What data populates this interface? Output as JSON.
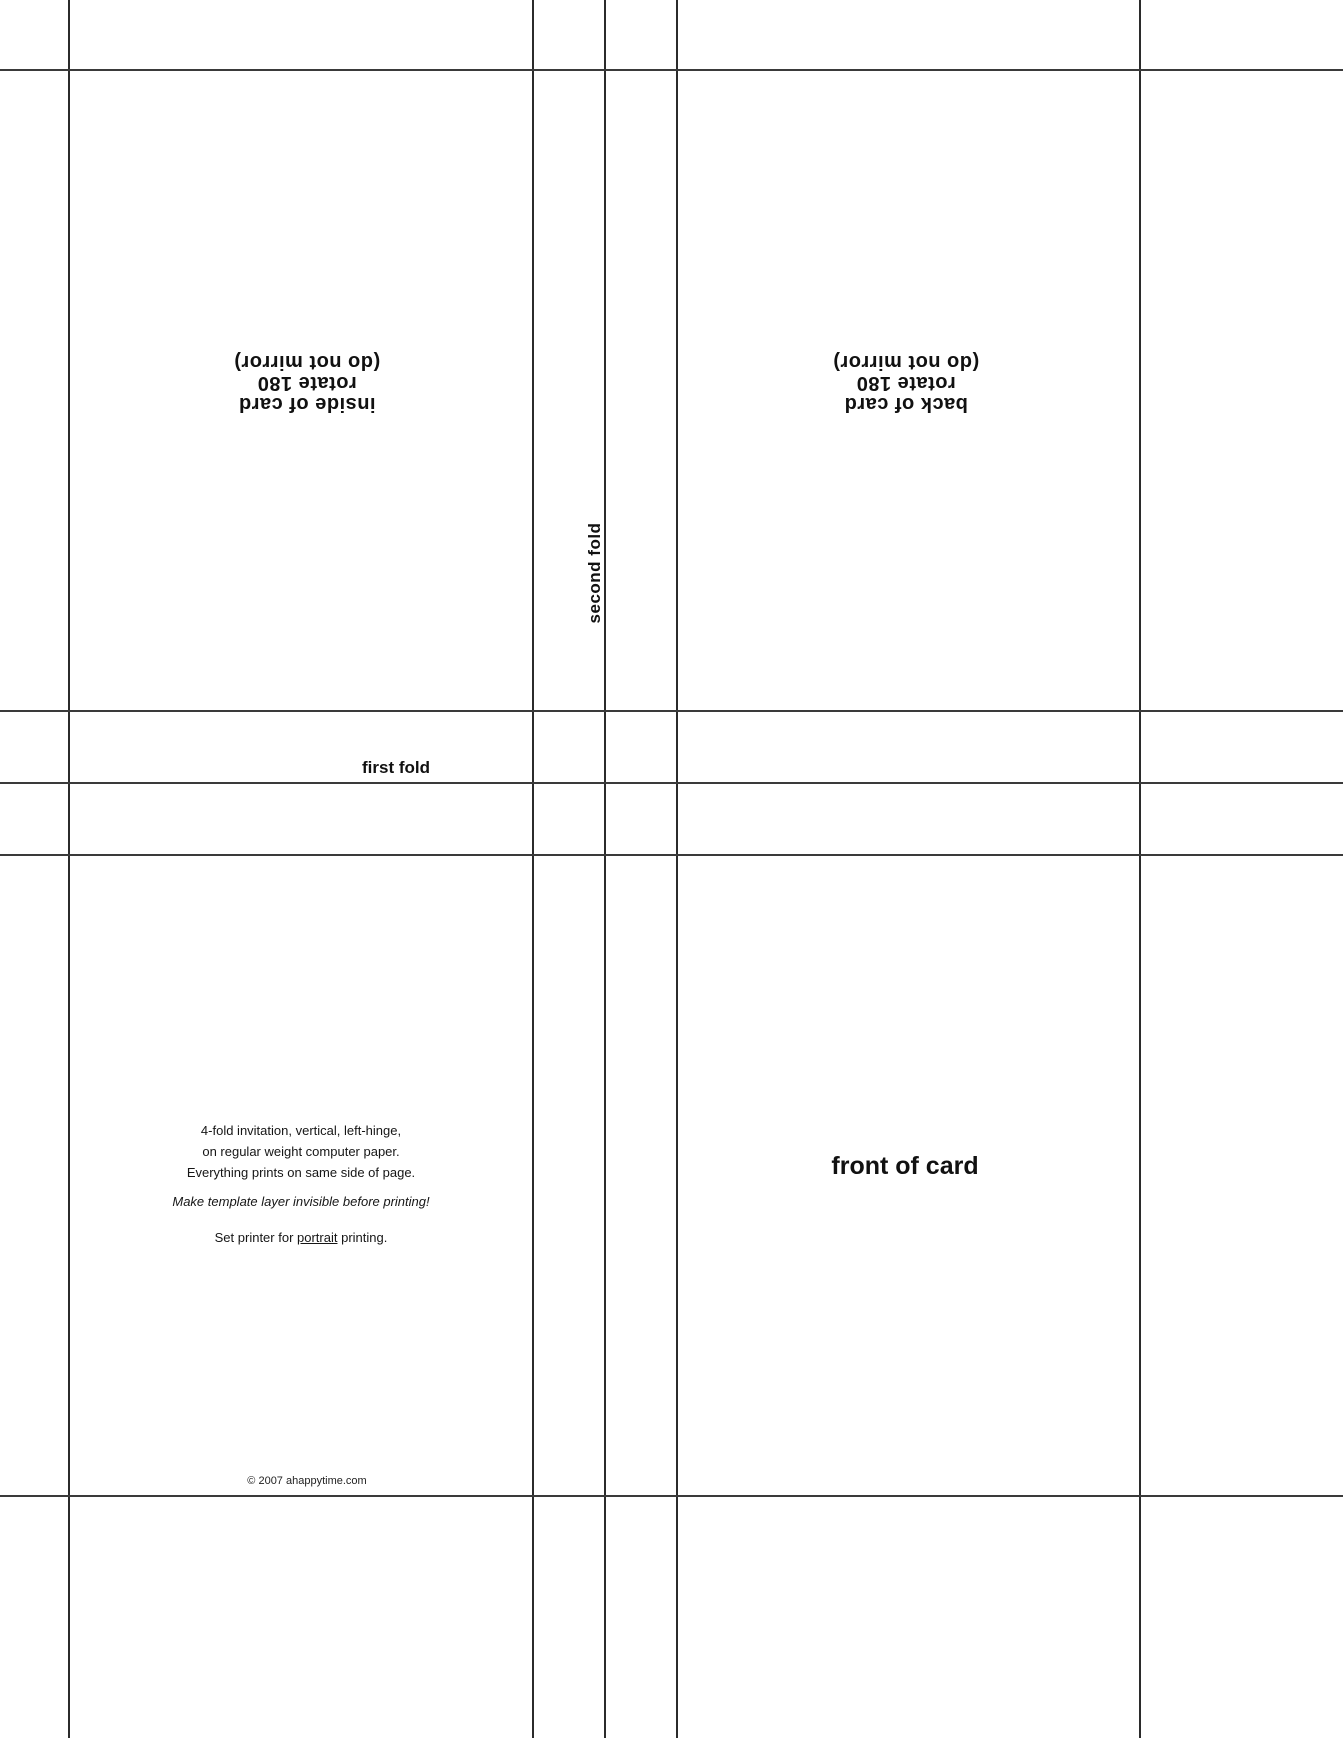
{
  "template": {
    "inside_label": {
      "line1": "inside of card",
      "line2": "rotate 180",
      "line3": "(do not mirror)"
    },
    "back_label": {
      "line1": "back of card",
      "line2": "rotate 180",
      "line3": "(do not mirror)"
    },
    "second_fold_label": "second fold",
    "first_fold_label": "first fold",
    "front_label": "front of card",
    "instructions": {
      "line1": "4-fold invitation, vertical, left-hinge,",
      "line2": "on regular weight computer paper.",
      "line3": "Everything prints on same side of page.",
      "note": "Make template layer invisible before printing!",
      "printer_prefix": "Set printer for ",
      "printer_emph": "portrait",
      "printer_suffix": " printing."
    },
    "copyright": "© 2007 ahappytime.com"
  },
  "colors": {
    "background": "#ffffff",
    "grid_line": "#2b2b2b",
    "text": "#111111"
  }
}
